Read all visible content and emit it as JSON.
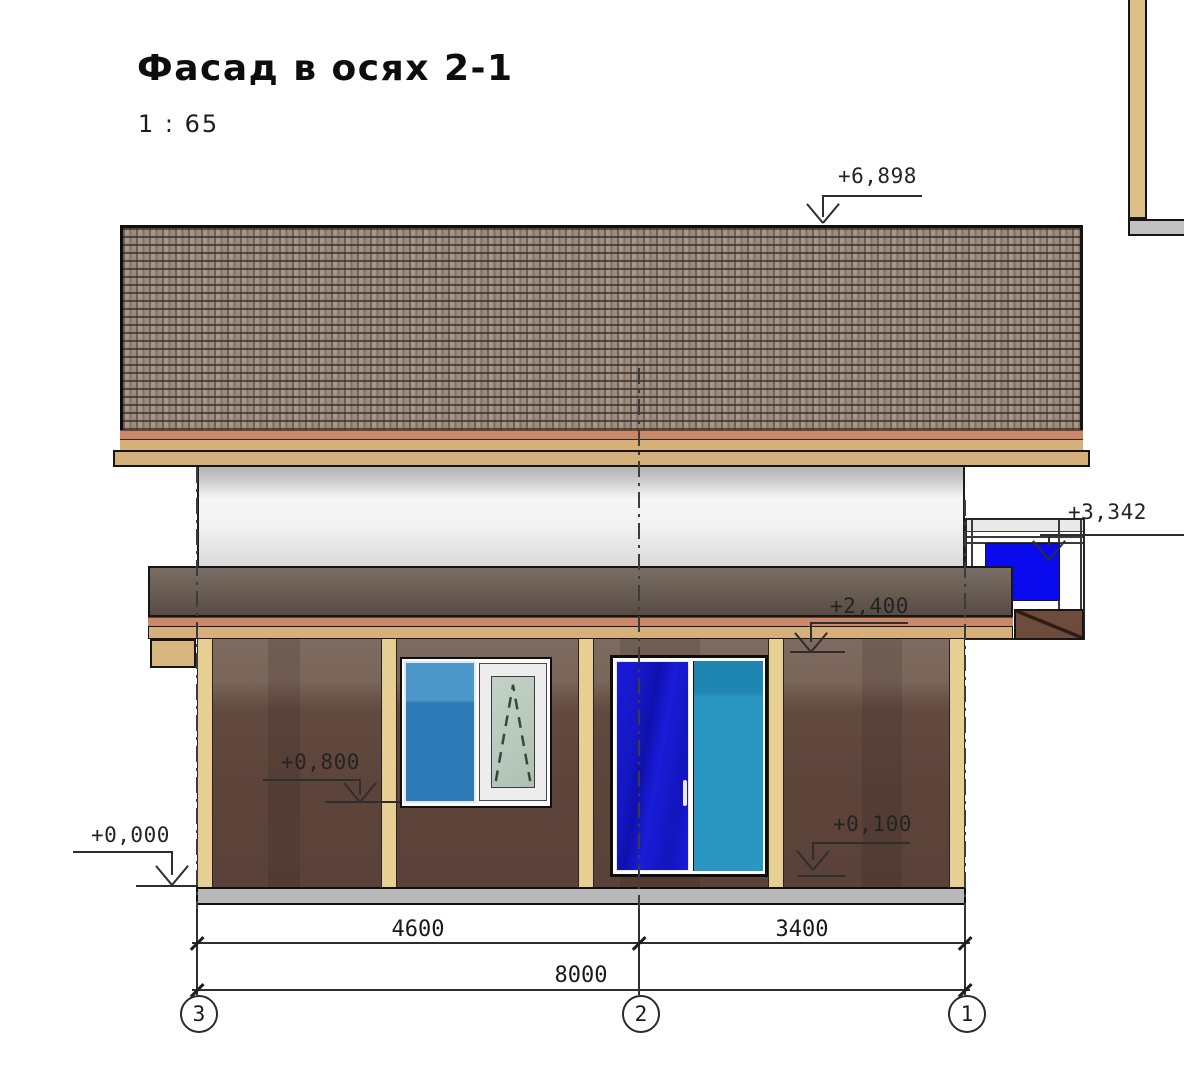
{
  "drawing": {
    "title": "Фасад в осях 2-1",
    "scale": "1 : 65",
    "type": "facade-elevation"
  },
  "elevation_marks": [
    {
      "id": "roof-ridge",
      "value": "+6,898"
    },
    {
      "id": "side-window-top",
      "value": "+3,342"
    },
    {
      "id": "first-floor-ceiling",
      "value": "+2,400"
    },
    {
      "id": "window-sill",
      "value": "+0,800"
    },
    {
      "id": "ground-level",
      "value": "+0,000"
    },
    {
      "id": "door-threshold",
      "value": "+0,100"
    }
  ],
  "dimensions": {
    "spans": [
      {
        "from_axis": "3",
        "to_axis": "2",
        "label": "4600"
      },
      {
        "from_axis": "2",
        "to_axis": "1",
        "label": "3400"
      }
    ],
    "total": {
      "from_axis": "3",
      "to_axis": "1",
      "label": "8000"
    }
  },
  "axes": {
    "bubbles": [
      {
        "label": "3"
      },
      {
        "label": "2"
      },
      {
        "label": "1"
      }
    ]
  },
  "colors": {
    "roof-base": "#9c8d80",
    "salmon": "#c9886a",
    "tan": "#d6b07a",
    "post": "#e7cf94",
    "wall-brown": "#5c443b",
    "floor-band": "#6b5e55",
    "foundation": "#b9b9b9",
    "blue-fixed": "#2c79b6",
    "blue-deep": "#1a1cd8",
    "blue-teal": "#2a97c2",
    "blue-bright": "#0a0aee",
    "glass-pale": "#b9c9bd",
    "line": "#2e2e2e"
  }
}
